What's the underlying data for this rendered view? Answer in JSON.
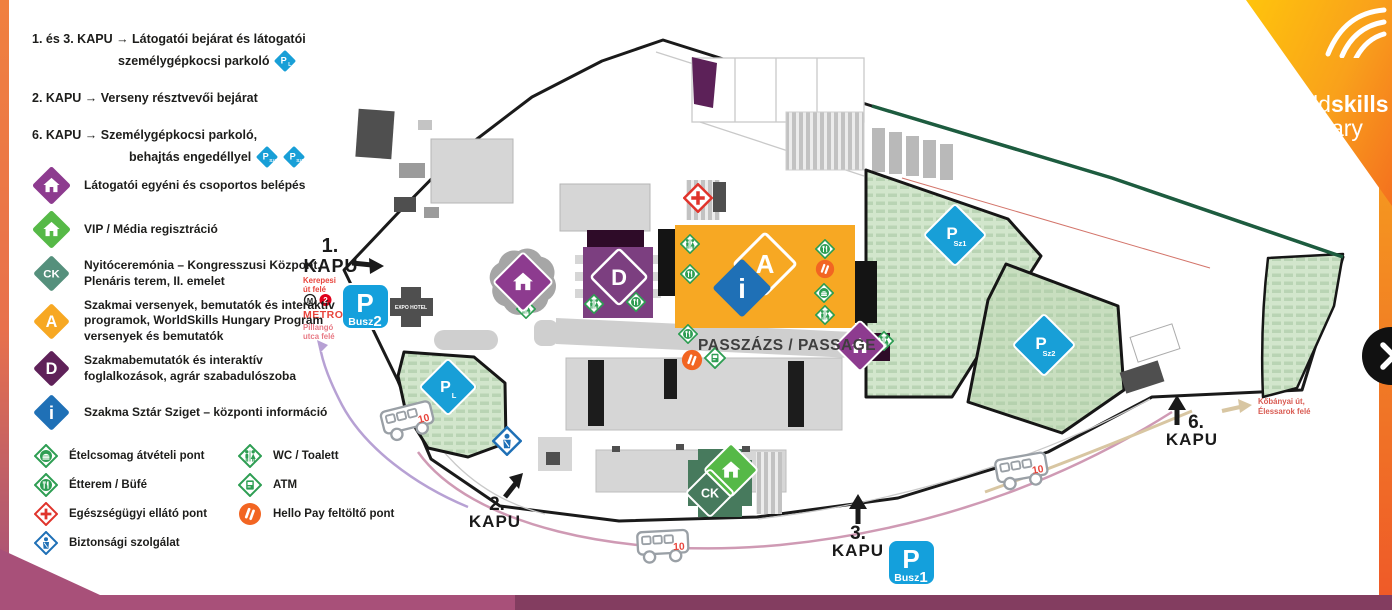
{
  "logo": {
    "word_light": "world",
    "word_bold": "skills",
    "country": "Hungary"
  },
  "notes": {
    "line1a": "1. és 3. KAPU → Látogatói bejárat és látogatói",
    "line1b": "személygépkocsi parkoló",
    "line2": "2. KAPU → Verseny résztvevői bejárat",
    "line3a": "6. KAPU → Személygépkocsi parkoló,",
    "line3b": "behajtás engedéllyel"
  },
  "legend": {
    "items": [
      {
        "symbol": "house",
        "color": "#8d3b8f",
        "label": "Látogatói egyéni és csoportos belépés"
      },
      {
        "symbol": "house",
        "color": "#56b947",
        "label": "VIP / Média regisztráció"
      },
      {
        "symbol": "CK",
        "color": "#55907c",
        "label": "Nyitóceremónia – Kongresszusi Központ, Plenáris terem, II. emelet"
      },
      {
        "symbol": "A",
        "color": "#f7a823",
        "label": "Szakmai versenyek, bemutatók és interaktív programok, WorldSkills Hungary Program versenyek és bemutatók"
      },
      {
        "symbol": "D",
        "color": "#5f2159",
        "label": "Szakmabemutatók és interaktív foglalkozások, agrár szabadulószoba"
      },
      {
        "symbol": "i",
        "color": "#1f70b6",
        "label": "Szakma Sztár Sziget – központi információ"
      }
    ]
  },
  "services": {
    "col1": [
      {
        "icon": "food-package",
        "label": "Ételcsomag átvételi pont"
      },
      {
        "icon": "restaurant",
        "label": "Étterem / Büfé"
      },
      {
        "icon": "medical",
        "label": "Egészségügyi ellátó pont"
      },
      {
        "icon": "security",
        "label": "Biztonsági szolgálat"
      }
    ],
    "col2": [
      {
        "icon": "wc",
        "label": "WC / Toalett"
      },
      {
        "icon": "atm",
        "label": "ATM"
      },
      {
        "icon": "hellopay",
        "label": "Hello Pay feltöltő pont"
      }
    ]
  },
  "map": {
    "passage": "PASSZÁZS / PASSAGE",
    "expo_hotel": "EXPO HOTEL",
    "bus_number": "10",
    "gates": {
      "g1": {
        "num": "1.",
        "word": "KAPU"
      },
      "g2": {
        "num": "2.",
        "word": "KAPU"
      },
      "g3": {
        "num": "3.",
        "word": "KAPU"
      },
      "g6": {
        "num": "6.",
        "word": "KAPU"
      }
    },
    "metro": {
      "toward_kerepesi_1": "Kerepesi",
      "toward_kerepesi_2": "út felé",
      "m": "M",
      "line": "2",
      "name": "METRO",
      "toward_pillango_1": "Pillangó",
      "toward_pillango_2": "utca felé"
    },
    "busz1": {
      "p": "P",
      "word": "Busz",
      "num": "1"
    },
    "busz2": {
      "p": "P",
      "word": "Busz",
      "num": "2"
    },
    "kobanyai": {
      "line1": "Kőbányai út,",
      "line2": "Élessarok felé"
    },
    "parking": {
      "pl": {
        "p": "P",
        "sub": "L"
      },
      "psz1": {
        "p": "P",
        "sub": "Sz1"
      },
      "psz2": {
        "p": "P",
        "sub": "Sz2"
      }
    },
    "buildings": {
      "a": "A",
      "d": "D",
      "ck": "CK",
      "info": "i"
    }
  },
  "next_button": {
    "icon": "chevron-right"
  },
  "colors": {
    "accent_orange": "#f7941e",
    "brand_yellow": "#ffc40c",
    "maroon_strip": "#a85079",
    "maroon_strip_dark": "#833d60",
    "parking_blue": "#189fd7",
    "busz_blue": "#14a0dc",
    "map_green_parking": "#d2e6cc",
    "building_orange": "#f7a823",
    "building_purple": "#7c3f80",
    "building_dark_purple": "#5c2158",
    "ck_green": "#477a5d",
    "vip_green": "#56b947",
    "info_blue": "#1f70b6",
    "visitor_purple": "#8d3b8f",
    "service_green": "#2e9e53",
    "medical_red": "#e0342c",
    "security_blue": "#1f70b6",
    "hellopay_orange": "#f26522",
    "metro_red": "#e8453c",
    "route_purple": "#b7a1d4",
    "route_pink": "#cf9ab4",
    "route_beige": "#d8c6a2",
    "text_dark": "#1d1d1b"
  }
}
